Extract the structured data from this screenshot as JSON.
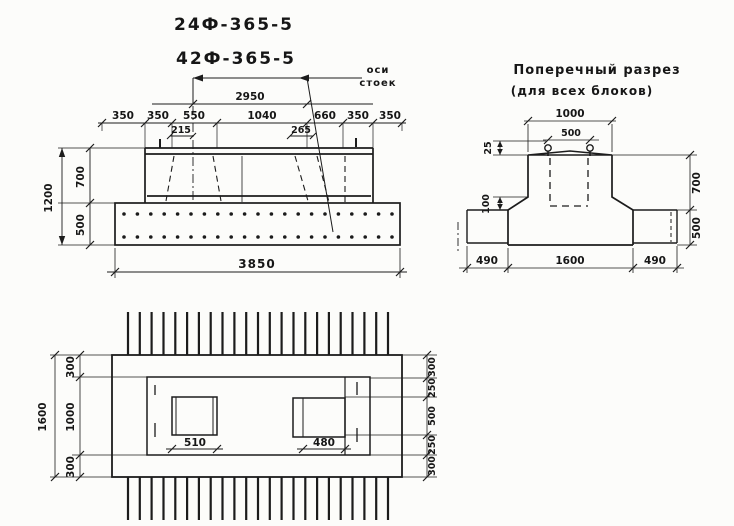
{
  "sheet": {
    "background": "#fcfcfa",
    "ink": "#1c1c1c"
  },
  "titles": {
    "mark1": "24Ф-365-5",
    "mark2": "42Ф-365-5"
  },
  "axes_note": {
    "line1": "оси",
    "line2": "стоек"
  },
  "elevation": {
    "span": "2950",
    "dim_row": [
      "350",
      "350",
      "550",
      "1040",
      "660",
      "350",
      "350"
    ],
    "sub_left": "215",
    "sub_right": "265",
    "height_total": "1200",
    "height_top": "700",
    "height_bottom": "500",
    "width_total": "3850"
  },
  "cross_section": {
    "title_line1": "Поперечный разрез",
    "title_line2": "(для всех блоков)",
    "dim_top": "1000",
    "dim_top_inner": "500",
    "dim_crown": "25",
    "dim_haunch": "100",
    "dim_height_top": "700",
    "dim_height_bottom": "500",
    "dim_bottom": [
      "490",
      "1600",
      "490"
    ]
  },
  "plan": {
    "dim_height_total": "1600",
    "dim_left": [
      "300",
      "1000",
      "300"
    ],
    "dim_right": [
      "300",
      "250",
      "500",
      "250",
      "300"
    ],
    "dim_socket_left": "510",
    "dim_socket_right": "480"
  }
}
